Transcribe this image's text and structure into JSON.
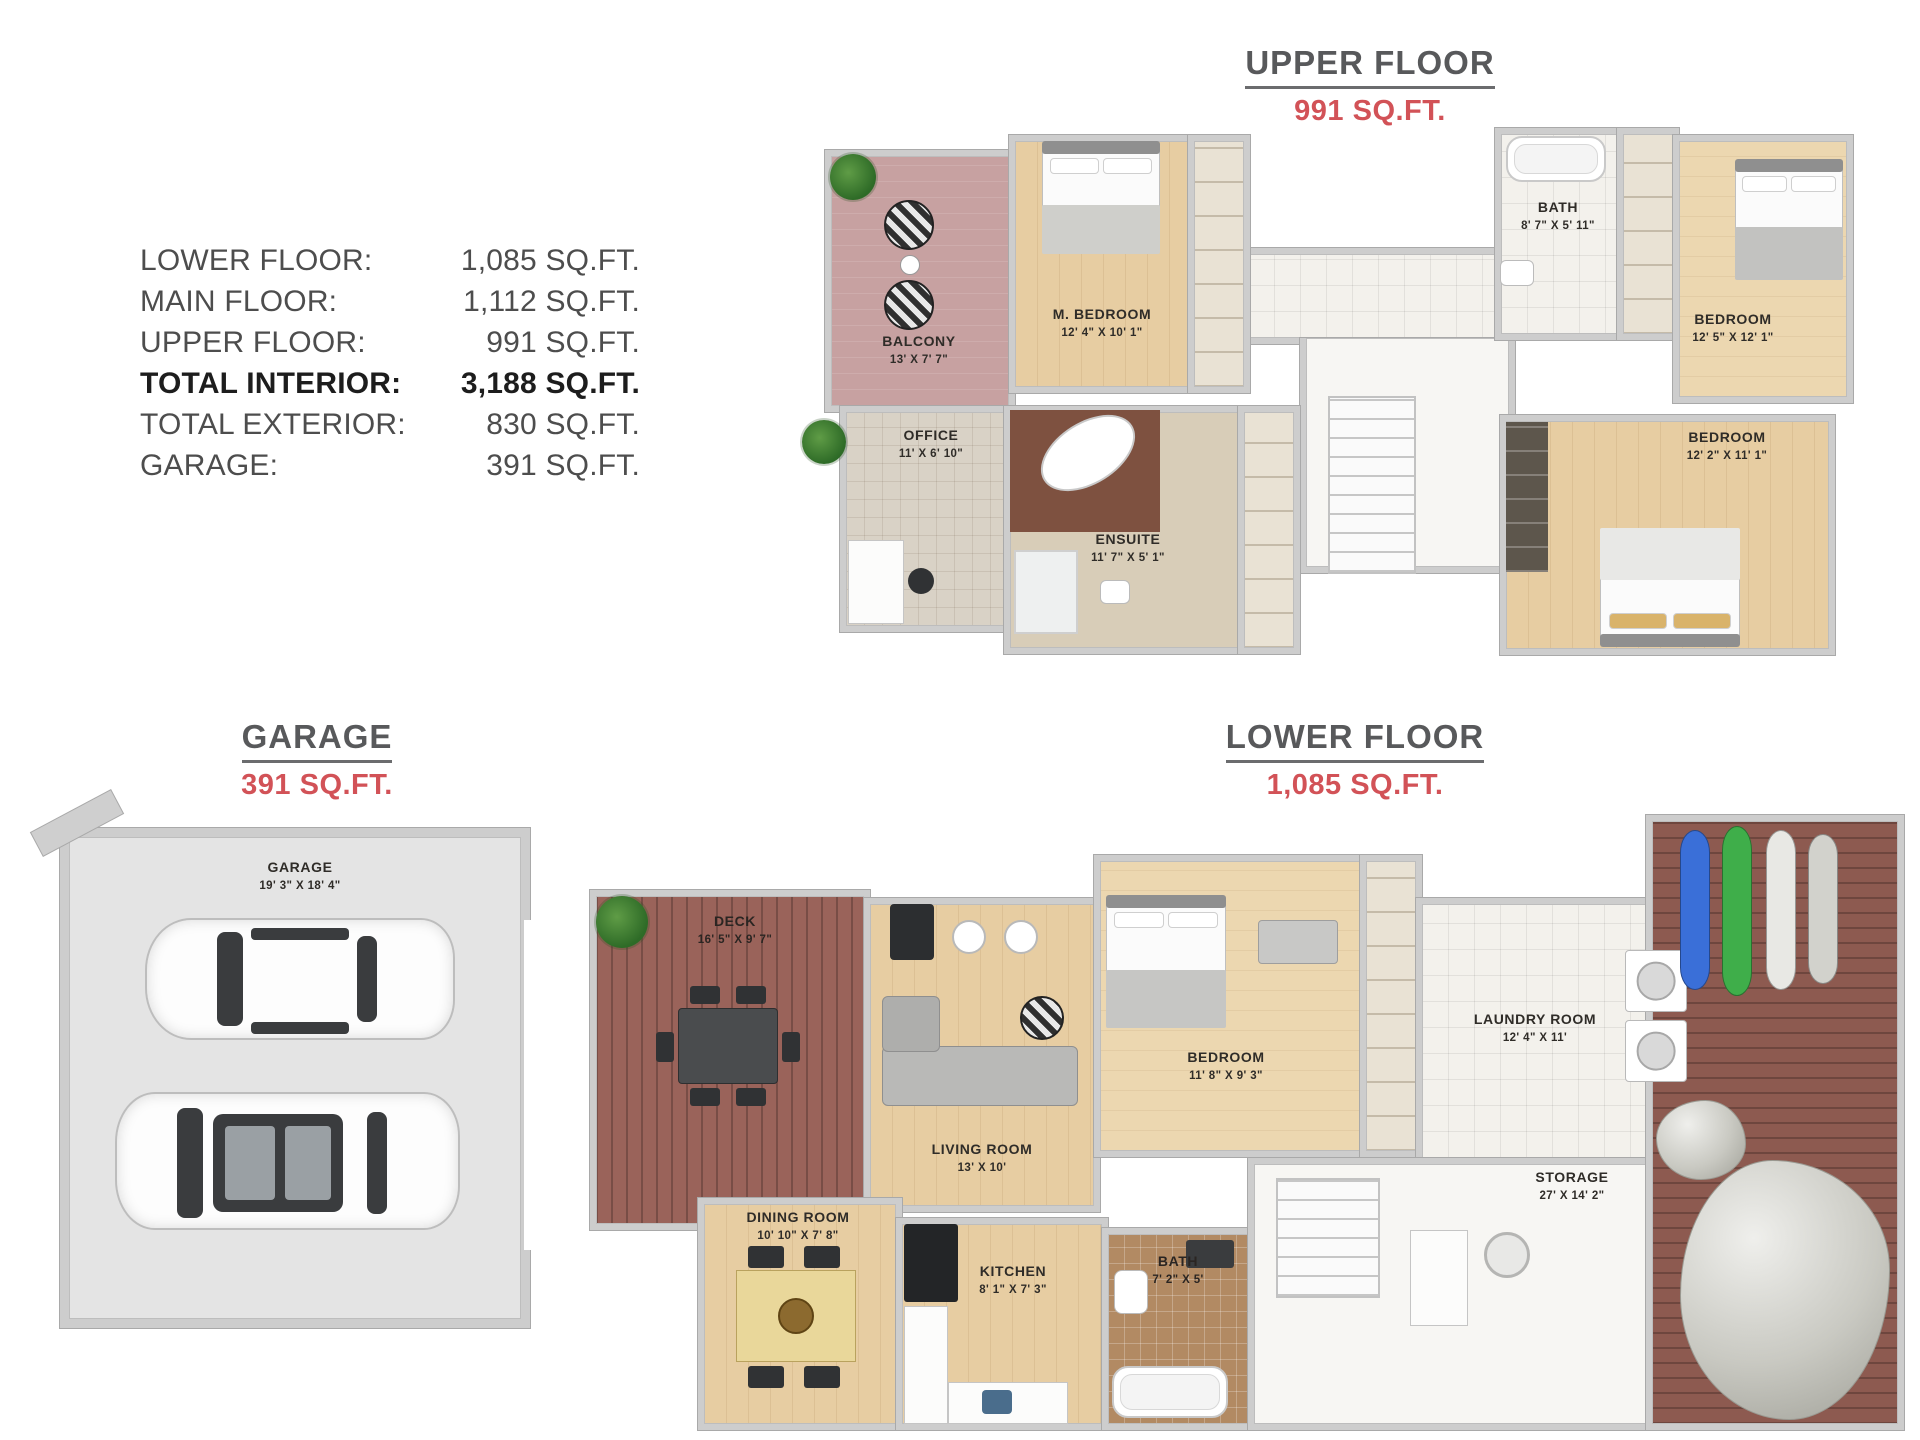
{
  "stats": {
    "rows": [
      {
        "label": "LOWER FLOOR:",
        "value": "1,085 SQ.FT."
      },
      {
        "label": "MAIN FLOOR:",
        "value": "1,112 SQ.FT."
      },
      {
        "label": "UPPER FLOOR:",
        "value": "991 SQ.FT."
      },
      {
        "label": "TOTAL INTERIOR:",
        "value": "3,188 SQ.FT."
      },
      {
        "label": "TOTAL EXTERIOR:",
        "value": "830 SQ.FT."
      },
      {
        "label": "GARAGE:",
        "value": "391 SQ.FT."
      }
    ]
  },
  "sections": {
    "upper_floor": {
      "title": "UPPER FLOOR",
      "area": "991 SQ.FT."
    },
    "garage": {
      "title": "GARAGE",
      "area": "391 SQ.FT."
    },
    "lower_floor": {
      "title": "LOWER FLOOR",
      "area": "1,085 SQ.FT."
    }
  },
  "rooms": {
    "upper": {
      "balcony": {
        "name": "BALCONY",
        "dims": "13' X 7' 7\""
      },
      "master_bedroom": {
        "name": "M. BEDROOM",
        "dims": "12' 4\" X 10' 1\""
      },
      "bath": {
        "name": "BATH",
        "dims": "8' 7\" X 5' 11\""
      },
      "bedroom_right": {
        "name": "BEDROOM",
        "dims": "12' 5\" X 12' 1\""
      },
      "office": {
        "name": "OFFICE",
        "dims": "11' X 6' 10\""
      },
      "ensuite": {
        "name": "ENSUITE",
        "dims": "11' 7\" X 5' 1\""
      },
      "bedroom_lower": {
        "name": "BEDROOM",
        "dims": "12' 2\" X 11' 1\""
      }
    },
    "garage": {
      "garage": {
        "name": "GARAGE",
        "dims": "19' 3\" X 18' 4\""
      }
    },
    "lower": {
      "deck": {
        "name": "DECK",
        "dims": "16' 5\" X 9' 7\""
      },
      "living_room": {
        "name": "LIVING ROOM",
        "dims": "13' X 10'"
      },
      "bedroom": {
        "name": "BEDROOM",
        "dims": "11' 8\" X 9' 3\""
      },
      "laundry_room": {
        "name": "LAUNDRY ROOM",
        "dims": "12' 4\" X 11'"
      },
      "dining_room": {
        "name": "DINING ROOM",
        "dims": "10' 10\" X 7' 8\""
      },
      "kitchen": {
        "name": "KITCHEN",
        "dims": "8' 1\" X 7' 3\""
      },
      "bath": {
        "name": "BATH",
        "dims": "7' 2\" X 5'"
      },
      "storage": {
        "name": "STORAGE",
        "dims": "27' X 14' 2\""
      }
    }
  },
  "colors": {
    "title_text": "#58595b",
    "area_text": "#d25257",
    "stats_text": "#4d4d4d",
    "wood_floor": "#e7cda2",
    "deck_wood": "#9a635a",
    "balcony_floor": "#c7a1a1",
    "tile_floor": "#f3f1ec",
    "wall": "#cdcdcd"
  }
}
